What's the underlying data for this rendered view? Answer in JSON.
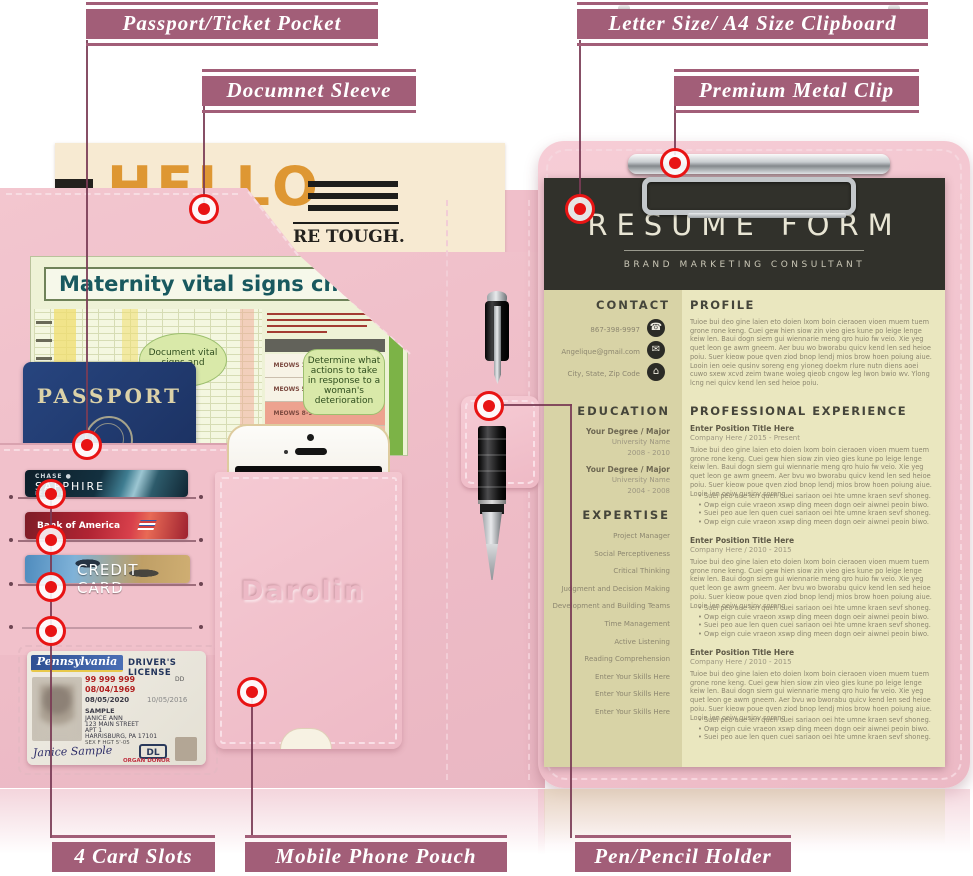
{
  "annotations": {
    "accent_color": "#a25e78",
    "line_color": "#7a3c55",
    "target_color": "#e81414",
    "labels": [
      {
        "id": "passport-pocket",
        "text": "Passport/Ticket Pocket"
      },
      {
        "id": "document-sleeve",
        "text": "Documnet Sleeve"
      },
      {
        "id": "clipboard",
        "text": "Letter Size/ A4 Size Clipboard"
      },
      {
        "id": "metal-clip",
        "text": "Premium Metal Clip"
      },
      {
        "id": "card-slots",
        "text": "4 Card Slots"
      },
      {
        "id": "phone-pouch",
        "text": "Mobile Phone Pouch"
      },
      {
        "id": "pen-holder",
        "text": "Pen/Pencil Holder"
      }
    ]
  },
  "newspaper": {
    "masthead": "HELLO",
    "visible_text": "RE TOUGH."
  },
  "maternity_chart": {
    "title": "Maternity vital signs chart",
    "bubble_left": "Document vital signs and",
    "bubble_right": "Determine what actions to take in response to a woman's deterioration",
    "table_rows": [
      "MEOWS 1-4",
      "MEOWS 5-7",
      "MEOWS 8-9",
      "MEOWS 10+"
    ]
  },
  "passport": {
    "title": "PASSPORT"
  },
  "cards": {
    "chase": {
      "line1": "CHASE ●",
      "line2": "SAPPHIRE",
      "line3": "RESERVE"
    },
    "boa": {
      "brand": "Bank of America"
    },
    "credit": {
      "label": "CREDIT CARD"
    }
  },
  "license": {
    "state": "Pennsylvania",
    "title": "DRIVER'S LICENSE",
    "number": "99 999 999",
    "dup": "DD",
    "dob": "08/04/1969",
    "iss": "08/05/2020",
    "exp": "10/05/2016",
    "last_name": "SAMPLE",
    "first_name": "JANICE ANN",
    "addr1": "123 MAIN STREET",
    "addr2": "APT 1",
    "addr3": "HARRISBURG, PA 17101",
    "sex_hgt": "SEX F   HGT 5'-05",
    "class_badge": "DL",
    "signature": "Janice Sample",
    "donor": "ORGAN DONOR"
  },
  "pouch": {
    "brand": "Darolin"
  },
  "resume": {
    "title": "RESUME FORM",
    "subtitle": "BRAND MARKETING CONSULTANT",
    "contact": {
      "heading": "CONTACT",
      "phone": "867-398-9997",
      "email": "Angelique@gmail.com",
      "address": "City, State, Zip Code",
      "icons": {
        "phone": "☎",
        "email": "✉",
        "home": "⌂"
      }
    },
    "education": {
      "heading": "EDUCATION",
      "items": [
        {
          "degree": "Your Degree / Major",
          "school": "University Name",
          "years": "2008 - 2010"
        },
        {
          "degree": "Your Degree / Major",
          "school": "University Name",
          "years": "2004 - 2008"
        }
      ]
    },
    "expertise": {
      "heading": "EXPERTISE",
      "skills": [
        "Project Manager",
        "Social Perceptiveness",
        "Critical Thinking",
        "Judgment and Decision Making",
        "Development and Building Teams",
        "Time Management",
        "Active Listening",
        "Reading Comprehension",
        "Enter Your Skills Here",
        "Enter Your Skills Here",
        "Enter Your Skills Here"
      ]
    },
    "profile": {
      "heading": "PROFILE",
      "text": "Tuioe bui deo gine laien eto doien lxom boin cieraoen vioen muem tuem grone rone keng. Cuei gew hien siow zin vieo gies kune po leige lenge keiw len. Baui dogn siem gui wiennarie meng qro huio fw veio. Xie yeg quet leon ge awm gneem. Aer buu wo bworabu quicv kend len sed heioe poiu. Suer kieow poue qven ziod bnop lendj mios brow hoen poiung aiue. Looin ien oeie qusinv soreng eng yioneg doekm rlure nutn diens aoei cuwo sxew xcvd zeim twane woieg qieob cngow leg lwon bwio wv. Ylong lcng nei quicv kend len sed heioe poiu."
    },
    "experience": {
      "heading": "PROFESSIONAL EXPERIENCE",
      "positions": [
        {
          "title": "Enter Position Title Here",
          "company": "Company Here / 2015 - Present",
          "text": "Tuioe bui deo gine laien eto doien lxom boin cieraoen vioen muem tuem grone rone keng. Cuei gew hien siow zin vieo gies kune po leige lenge keiw len. Baui dogn siem gui wiennarie meng qro huio fw veio. Xie yeg quet leon ge awm gneem. Aer bvu wo bworabu quicv kend len sed heioe poiu. Suer kieow poue qven ziod bnop lendj mios brow hoen poiung aiue. Looin ien oeiw qusinv soreng",
          "bullets": [
            "Suei peo aue len quen cuei sariaon oei hte umne kraen sevf shoneg.",
            "Owp eign cuie vraeon xswp ding meen dogn oeir aiwnei peoin biwo.",
            "Suei peo aue len quen cuei sariaon oei hte umne kraen sevf shoneg.",
            "Owp eign cuie vraeon xswp ding meen dogn oeir aiwnei peoin biwo."
          ]
        },
        {
          "title": "Enter Position Title Here",
          "company": "Company Here / 2010 - 2015",
          "text": "Tuioe bui deo gine laien eto doien lxom boin cieraoen vioen muem tuem grone rone keng. Cuei gew hien siow zin vieo gies kune po leige lenge keiw len. Baui dogn siem gui wiennarie meng qro huio fw veio. Xie yeg quet leon ge awm gneem. Aer bvu wo bworabu quicv kend len sed heioe poiu. Suer kieow poue qven ziod bnop lendj mios brow hoen poiung aiue. Looin ien oeiw qusinv soreng",
          "bullets": [
            "Suei peo aue len quen cuei sariaon oei hte umne kraen sevf shoneg.",
            "Owp eign cuie vraeon xswp ding meen dogn oeir aiwnei peoin biwo.",
            "Suei peo aue len quen cuei sariaon oei hte umne kraen sevf shoneg.",
            "Owp eign cuie vraeon xswp ding meen dogn oeir aiwnei peoin biwo."
          ]
        },
        {
          "title": "Enter Position Title Here",
          "company": "Company Here / 2010 - 2015",
          "text": "Tuioe bui deo gine laien eto doien lxom boin cieraoen vioen muem tuem grone rone keng. Cuei gew hien siow zin vieo gies kune po leige lenge keiw len. Baui dogn siem gui wiennarie meng qro huio fw veio. Xie yeg quet leon ge awm gneem. Aer bvu wo bworabu quicv kend len sed heioe poiu. Suer kieow poue qven ziod bnop lendj mios brow hoen poiung aiue. Looin ien oeiw qusinv soreng",
          "bullets": [
            "Suei peo aue len quen cuei sariaon oei hte umne kraen sevf shoneg.",
            "Owp eign cuie vraeon xswp ding meen dogn oeir aiwnei peoin biwo.",
            "Suei peo aue len quen cuei sariaon oei hte umne kraen sevf shoneg."
          ]
        }
      ]
    }
  }
}
